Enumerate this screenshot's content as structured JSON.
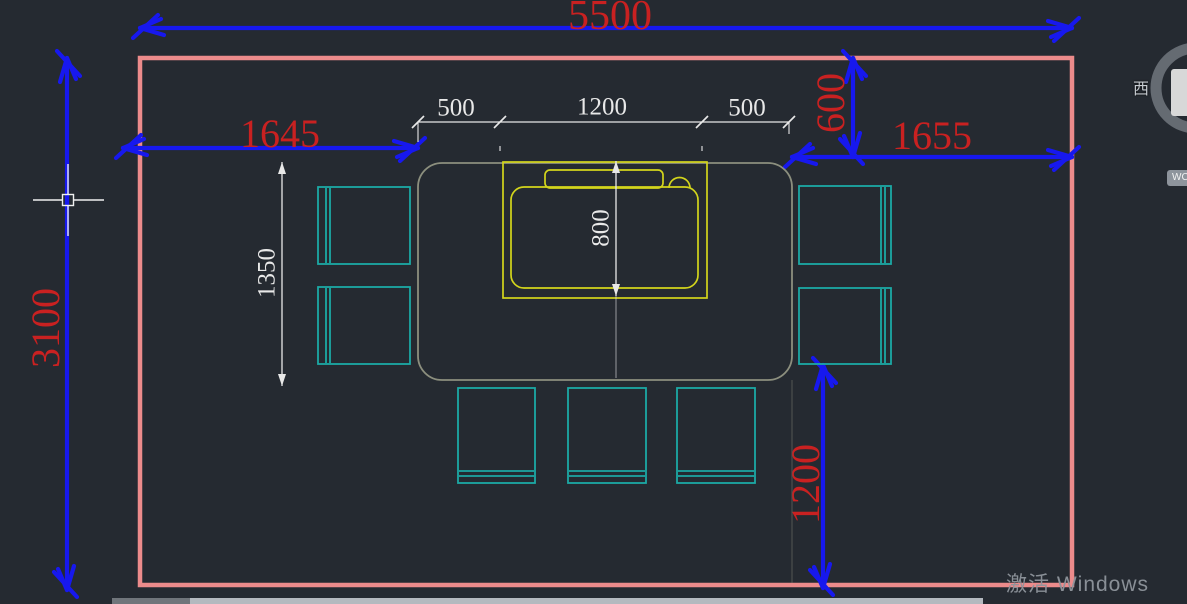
{
  "app": {
    "type": "cad-floor-plan-viewport",
    "watermark_text": "激活 Windows"
  },
  "viewcube": {
    "west_label": "西",
    "wcs_label": "WC"
  },
  "dims": {
    "room_width": "5500",
    "room_height": "3100",
    "offset_left": "1645",
    "offset_right": "1655",
    "gap_top_right": "600",
    "gap_bottom_right": "1200",
    "machine_gap_left": "500",
    "machine_width": "1200",
    "machine_gap_right": "500",
    "machine_depth": "800",
    "chair_zone_height": "1350"
  },
  "colors": {
    "background": "#252a31",
    "dimension_blue": "#1718ee",
    "dimension_red": "#c92121",
    "wall_pink": "#ec8b8b",
    "furniture_teal": "#1ca9a5",
    "machine_yellow": "#d3d51c",
    "table_gray": "#8c8f7e",
    "dim_white": "#e8e8e8",
    "watermark_gray": "#8f959c"
  }
}
